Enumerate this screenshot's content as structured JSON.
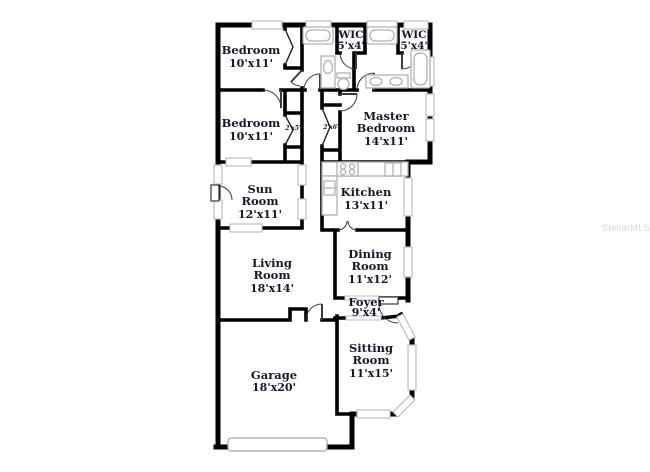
{
  "watermark": "StellarMLS",
  "colors": {
    "background": "#ffffff",
    "wall": "#000000",
    "label_text": "#17172b",
    "window_trim": "#bdbdbd",
    "fixture": "#b0b0b0",
    "watermark": "#d6d6d6"
  },
  "rooms": {
    "bedroom_top": {
      "name": "Bedroom",
      "dims": "10'x11'"
    },
    "wic_left": {
      "name": "WIC",
      "dims": "5'x4'"
    },
    "wic_right": {
      "name": "WIC",
      "dims": "5'x4'"
    },
    "bedroom_mid": {
      "name": "Bedroom",
      "dims": "10'x11'"
    },
    "master_bedroom": {
      "name_line1": "Master",
      "name_line2": "Bedroom",
      "dims": "14'x11'"
    },
    "closet_left": {
      "dims": "2'x5'"
    },
    "closet_right": {
      "dims": "2'x6'"
    },
    "sun_room": {
      "name_line1": "Sun",
      "name_line2": "Room",
      "dims": "12'x11'"
    },
    "kitchen": {
      "name": "Kitchen",
      "dims": "13'x11'"
    },
    "living_room": {
      "name_line1": "Living",
      "name_line2": "Room",
      "dims": "18'x14'"
    },
    "dining_room": {
      "name_line1": "Dining",
      "name_line2": "Room",
      "dims": "11'x12'"
    },
    "foyer": {
      "name": "Foyer",
      "dims": "9'x4'"
    },
    "garage": {
      "name": "Garage",
      "dims": "18'x20'"
    },
    "sitting_room": {
      "name_line1": "Sitting",
      "name_line2": "Room",
      "dims": "11'x15'"
    }
  }
}
